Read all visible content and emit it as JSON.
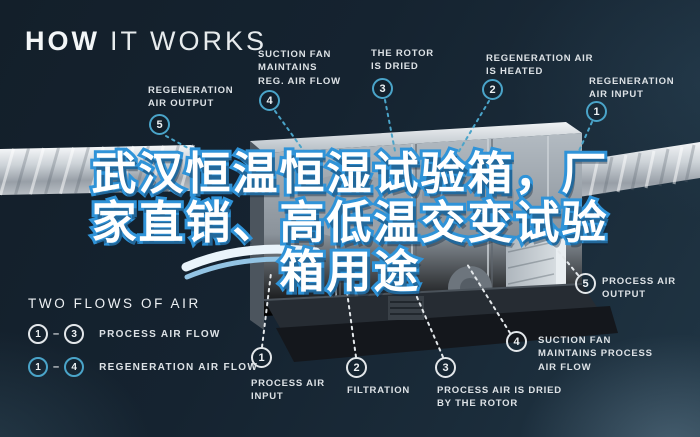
{
  "title": {
    "part1": "HOW",
    "part2": "IT WORKS"
  },
  "headline": {
    "lines": [
      "武汉恒温恒湿试验箱，厂",
      "家直销、高低温交变试验",
      "箱用途"
    ],
    "fill_color": "#ffffff",
    "outline_color": "#2f93d8"
  },
  "regeneration_callouts": [
    {
      "num": "5",
      "text": "REGENERATION\nAIR OUTPUT"
    },
    {
      "num": "4",
      "text": "SUCTION FAN\nMAINTAINS\nREG. AIR FLOW"
    },
    {
      "num": "3",
      "text": "THE ROTOR\nIS DRIED"
    },
    {
      "num": "2",
      "text": "REGENERATION AIR\nIS HEATED"
    },
    {
      "num": "1",
      "text": "REGENERATION\nAIR INPUT"
    }
  ],
  "process_callouts": [
    {
      "num": "1",
      "text": "PROCESS AIR\nINPUT"
    },
    {
      "num": "2",
      "text": "FILTRATION"
    },
    {
      "num": "3",
      "text": "PROCESS AIR IS DRIED\nBY THE ROTOR"
    },
    {
      "num": "4",
      "text": "SUCTION FAN\nMAINTAINS PROCESS\nAIR FLOW"
    },
    {
      "num": "5",
      "text": "PROCESS AIR\nOUTPUT"
    }
  ],
  "legend": {
    "title": "TWO FLOWS OF AIR",
    "rows": [
      {
        "from": "1",
        "dash": "–",
        "to": "3",
        "label": "PROCESS AIR FLOW"
      },
      {
        "from": "1",
        "dash": "–",
        "to": "4",
        "label": "REGENERATION AIR FLOW"
      }
    ]
  },
  "colors": {
    "background": "#15222f",
    "regeneration_accent": "#4aa4c9",
    "process_accent": "#e3e7ea",
    "label_text": "#dde2e6"
  }
}
